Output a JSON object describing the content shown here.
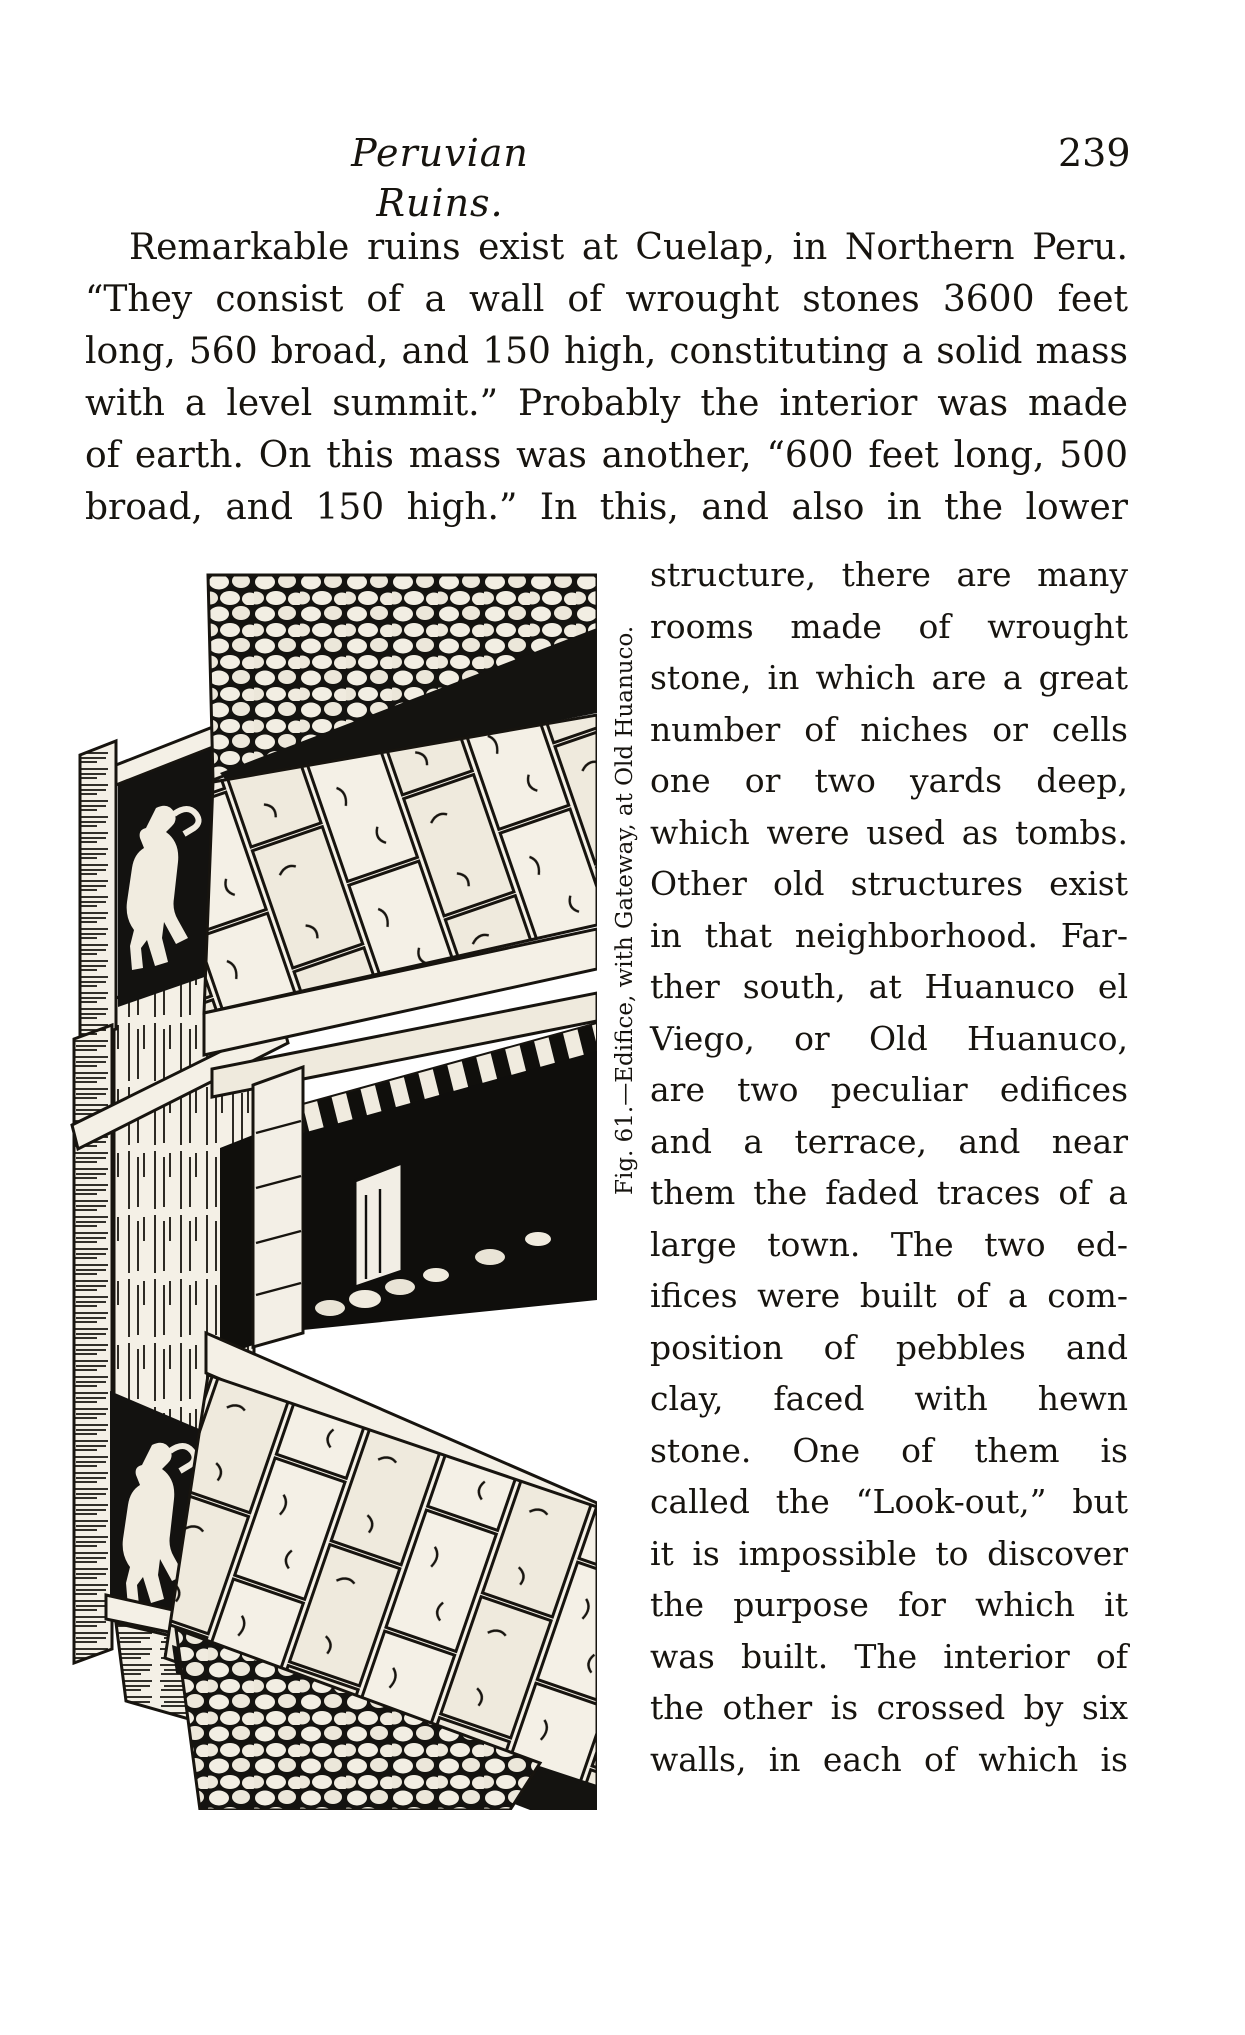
{
  "colors": {
    "paper": "#ffffff",
    "ink": "#17140f"
  },
  "header": {
    "title": "Peruvian Ruins.",
    "page_number": "239"
  },
  "paragraph": {
    "lines": [
      "Remarkable ruins exist at Cuelap, in Northern Peru.",
      "“They consist of a wall of wrought stones 3600 feet",
      "long, 560 broad, and 150 high, constituting a solid mass",
      "with a level summit.” Probably the interior was made",
      "of earth. On this mass was another, “600 feet long, 500",
      "broad, and 150 high.” In this, and also in the lower"
    ]
  },
  "figure": {
    "caption": "Fig. 61.—Edifice, with Gateway, at Old Huanuco."
  },
  "column": {
    "lines": [
      "structure, there are many",
      "rooms made of wrought",
      "stone, in which are a great",
      "number of niches or cells",
      "one or two yards deep,",
      "which were used as tombs.",
      "Other old structures exist",
      "in that neighborhood. Far-",
      "ther south, at Huanuco el",
      "Viego, or Old Huanuco,",
      "are two peculiar edifices",
      "and a terrace, and near",
      "them the faded traces of a",
      "large town. The two ed-",
      "ifices were built of a com-",
      "position of pebbles and",
      "clay, faced with hewn",
      "stone. One of them is",
      "called the “Look-out,” but",
      "it is impossible to discover",
      "the purpose for which it",
      "was built. The interior of",
      "the other is crossed by six",
      "walls, in each of which is"
    ]
  }
}
